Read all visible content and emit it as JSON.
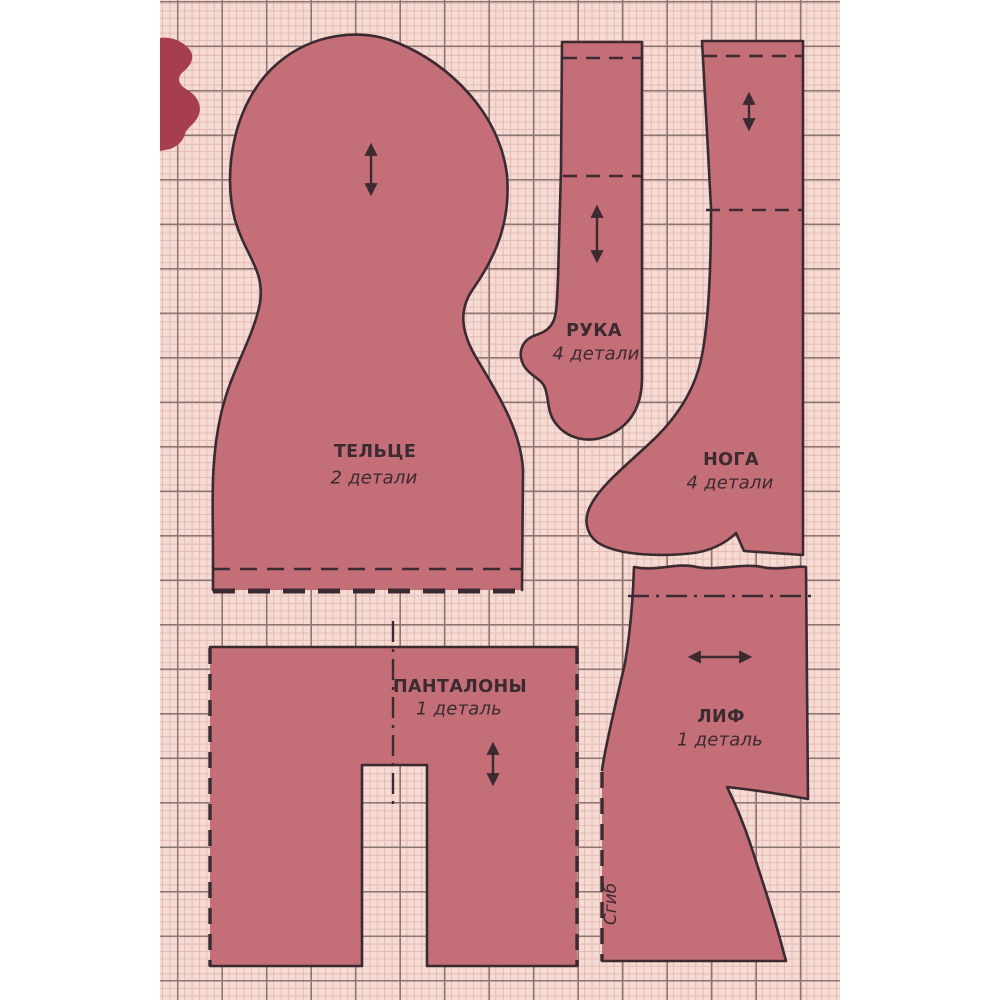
{
  "title": "Выкройка куклы (doll sewing pattern sheet)",
  "colors": {
    "page_bg": "#ffffff",
    "paper_bg": "#f5dbd3",
    "grid_minor": "#e3bbb2",
    "grid_major": "#8f7572",
    "piece_fill": "#c46e77",
    "piece_outline": "#3b2a32",
    "scrap_fill": "#a63e4d",
    "text": "#3b2a32"
  },
  "pieces": {
    "body": {
      "name": "ТЕЛЬЦЕ",
      "quantity": "2 детали"
    },
    "arm": {
      "name": "РУКА",
      "quantity": "4 детали"
    },
    "leg": {
      "name": "НОГА",
      "quantity": "4 детали"
    },
    "pantaloons": {
      "name": "ПАНТАЛОНЫ",
      "quantity": "1 деталь"
    },
    "bodice": {
      "name": "ЛИФ",
      "quantity": "1 деталь"
    }
  },
  "annotations": {
    "fold_label": "Сгиб"
  }
}
